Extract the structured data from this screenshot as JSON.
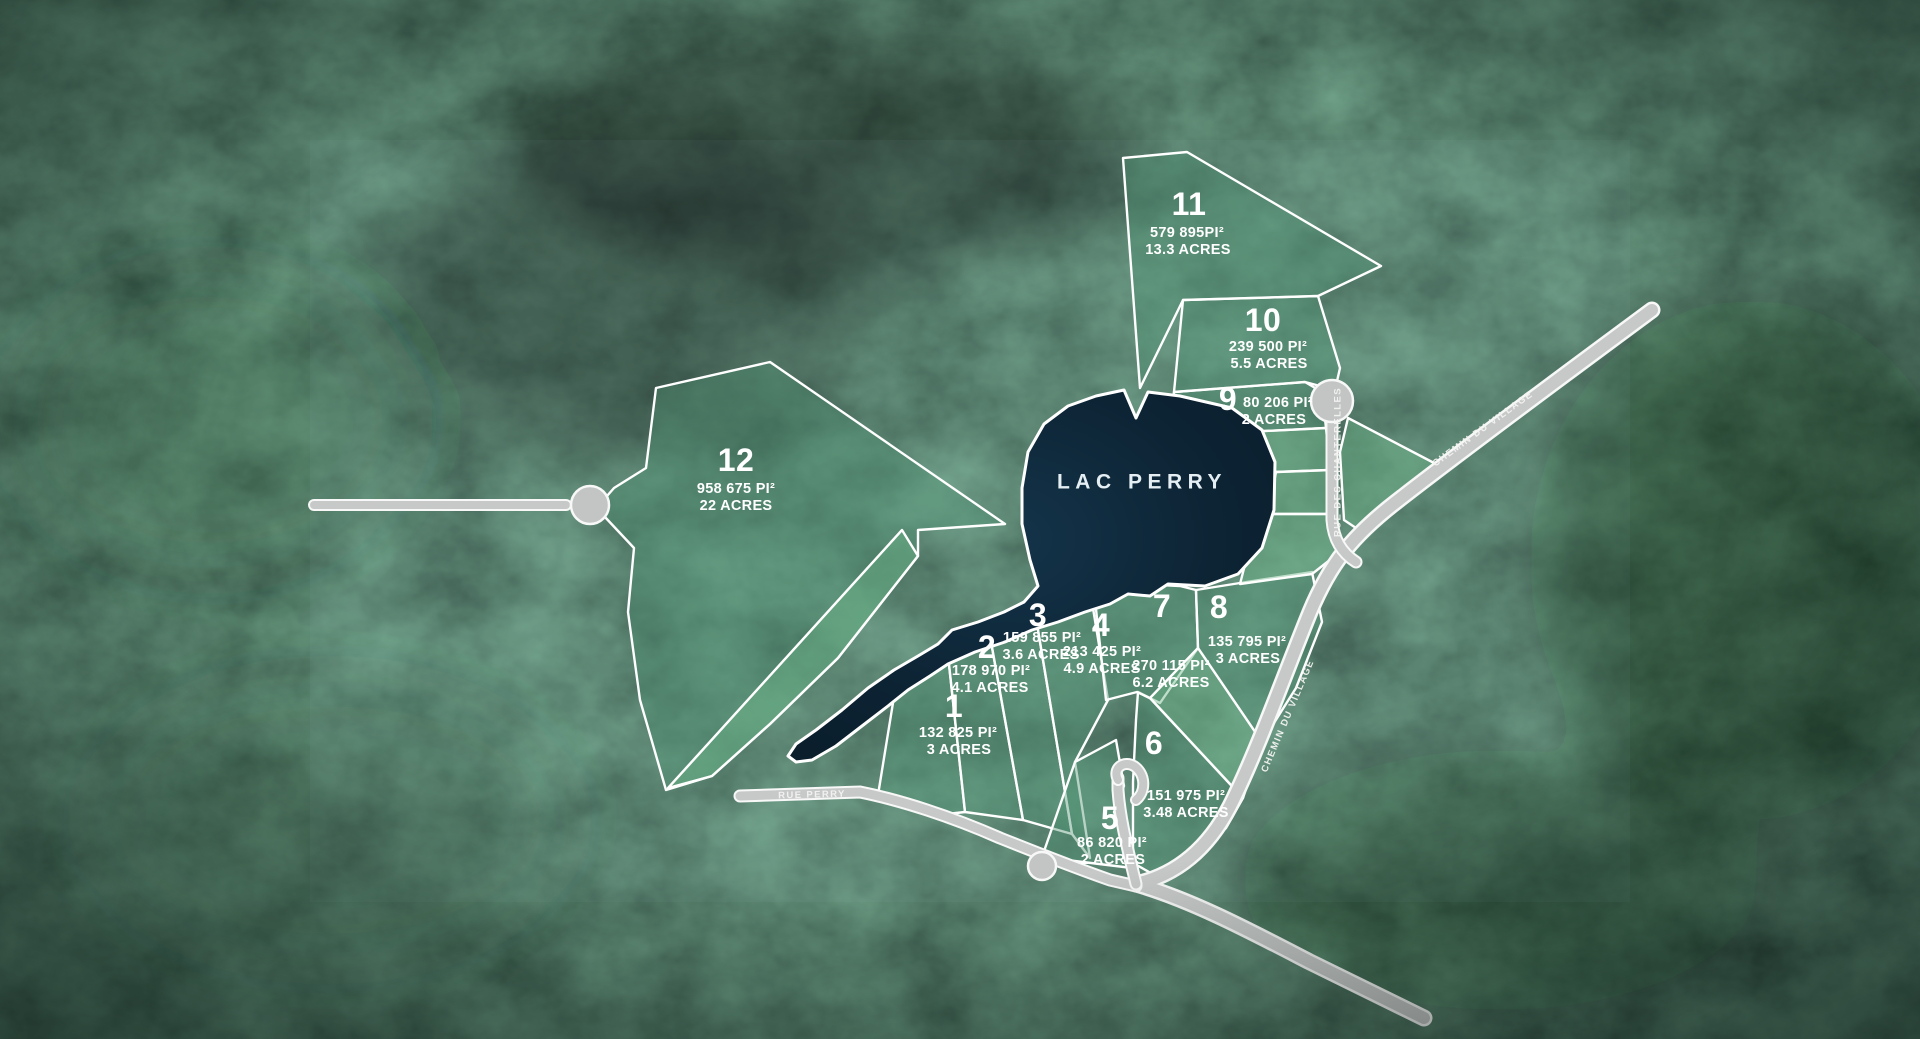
{
  "lake": {
    "label": "LAC PERRY"
  },
  "lots": [
    {
      "number": "1",
      "area": "132 825 PI²",
      "acres": "3 ACRES"
    },
    {
      "number": "2",
      "area": "178 970 PI²",
      "acres": "4.1 ACRES"
    },
    {
      "number": "3",
      "area": "159 855 PI²",
      "acres": "3.6 ACRES"
    },
    {
      "number": "4",
      "area": "213 425 PI²",
      "acres": "4.9 ACRES"
    },
    {
      "number": "5",
      "area": "86 820 PI²",
      "acres": "2 ACRES"
    },
    {
      "number": "6",
      "area": "151 975 PI²",
      "acres": "3.48 ACRES"
    },
    {
      "number": "7",
      "area": "270 115 PI²",
      "acres": "6.2 ACRES"
    },
    {
      "number": "8",
      "area": "135 795 PI²",
      "acres": "3 ACRES"
    },
    {
      "number": "9",
      "area": "80 206 PI²",
      "acres": "2 ACRES"
    },
    {
      "number": "10",
      "area": "239 500 PI²",
      "acres": "5.5 ACRES"
    },
    {
      "number": "11",
      "area": "579 895PI²",
      "acres": "13.3 ACRES"
    },
    {
      "number": "12",
      "area": "958 675 PI²",
      "acres": "22 ACRES"
    }
  ],
  "roads": {
    "perry": "RUE PERRY",
    "chanterelles": "RUE DES CHANTERELLES",
    "village_upper": "CHEMIN DU VILLAGE",
    "village_lower": "CHEMIN DU VILLAGE"
  },
  "colors": {
    "lot_fill": "#4d9070",
    "lot_fill_light": "#6fb58a",
    "lake": "#0d2333",
    "road": "#c6c9c8",
    "outline": "#ffffff"
  }
}
